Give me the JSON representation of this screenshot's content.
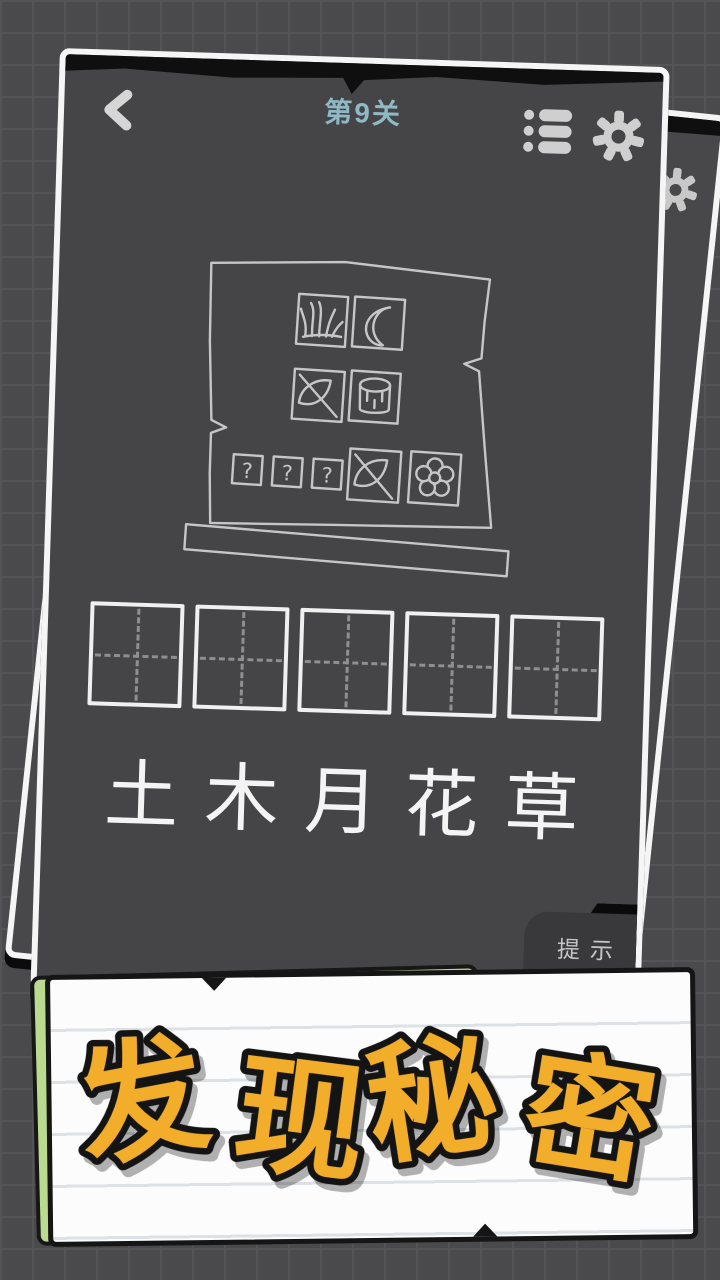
{
  "header": {
    "title": "第9关"
  },
  "icons": {
    "back": "chevron-left",
    "levels": "list",
    "settings": "gear",
    "board_tiles": [
      "grass",
      "moon",
      "leaf",
      "bucket",
      "question",
      "question",
      "question",
      "leaf",
      "flower"
    ]
  },
  "puzzle_board": {
    "question_mark": "?"
  },
  "answer_slots": {
    "count": 5
  },
  "clue_characters": [
    "土",
    "木",
    "月",
    "花",
    "草"
  ],
  "hint_button": {
    "label": "提示"
  },
  "ad_banner": {
    "text": "发现秘密"
  },
  "colors": {
    "background": "#4A4A4C",
    "card_bg": "#454547",
    "title": "#8FB9C4",
    "banner_bg": "#FCFCFD",
    "banner_text": "#F2AE2B",
    "green_card": "#B9DA8F"
  }
}
